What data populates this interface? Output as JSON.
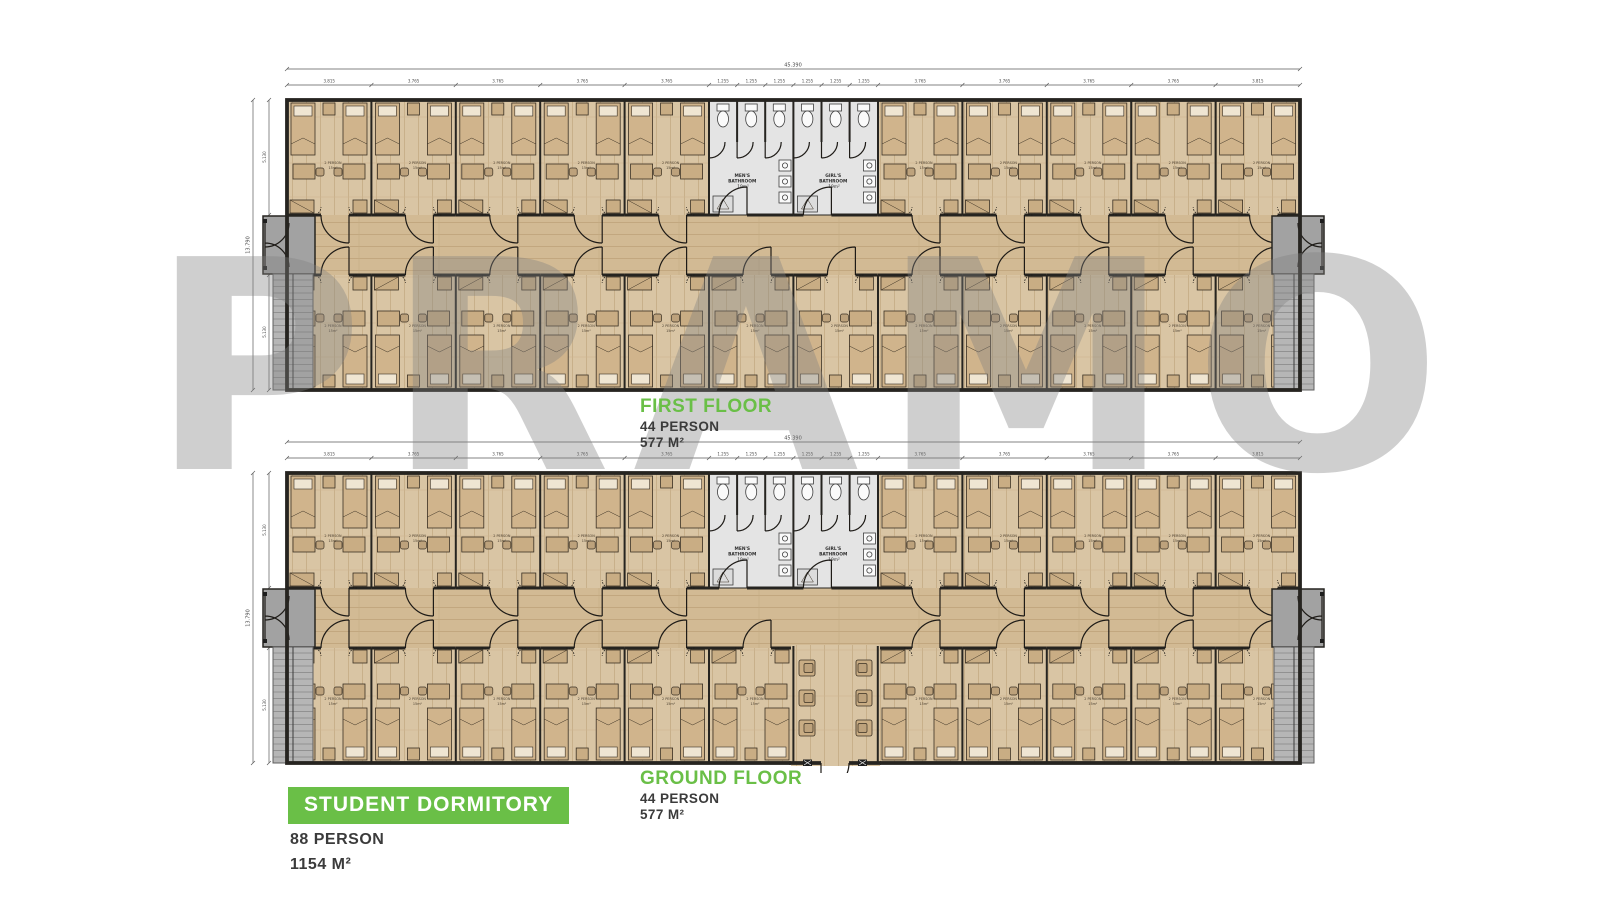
{
  "watermark": {
    "text": "PRAMO"
  },
  "floors": {
    "first": {
      "name": "FIRST FLOOR",
      "person": "44 PERSON",
      "area": "577 M²"
    },
    "ground": {
      "name": "GROUND FLOOR",
      "person": "44 PERSON",
      "area": "577 M²"
    }
  },
  "title": {
    "name": "STUDENT DORMITORY",
    "person": "88 PERSON",
    "area": "1154 M²"
  },
  "plan": {
    "room": {
      "label": "2 PERSON",
      "area": "15m²"
    },
    "bathrooms": {
      "mens": {
        "line1": "MEN'S",
        "line2": "BATHROOM",
        "area": "19m²"
      },
      "girls": {
        "line1": "GIRL'S",
        "line2": "BATHROOM",
        "area": "19m²"
      }
    },
    "dims": {
      "top_total": "45.390",
      "top_segments": [
        "3.815",
        "3.765",
        "3.765",
        "3.765",
        "3.765",
        "1.255",
        "1.255",
        "1.255",
        "1.255",
        "1.255",
        "1.255",
        "3.765",
        "3.765",
        "3.765",
        "3.765",
        "3.815"
      ],
      "left_total": "13.790",
      "left_segments": [
        "5.130",
        "3.530",
        "5.130"
      ]
    },
    "colors": {
      "accent_green": "#6abf47",
      "floor_tan": "#d9c5a4",
      "wall_dark": "#262420",
      "bath_gray": "#e4e4e4",
      "watermark_gray": "#d4d4d4"
    }
  }
}
